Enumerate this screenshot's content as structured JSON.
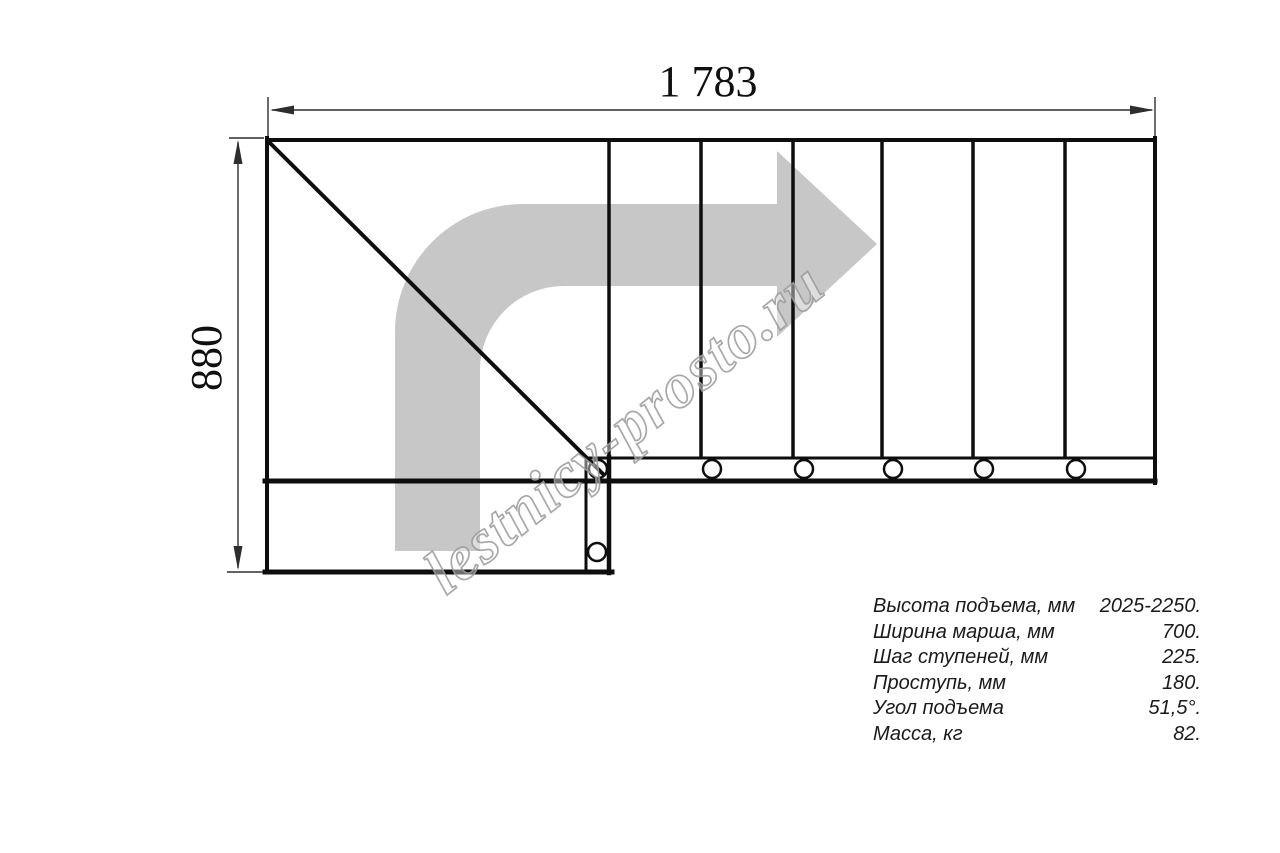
{
  "drawing": {
    "dim_width_label": "1 783",
    "dim_height_label": "880",
    "watermark": "lestnicy-prosto.ru",
    "colors": {
      "plan_line": "#0e0e0e",
      "dim_line": "#2e2e2e",
      "arrow_gray": "#c7c7c7",
      "watermark_gray": "#9f9f9f"
    }
  },
  "specs": {
    "rows": [
      {
        "label": "Высота подъема, мм",
        "value": "2025-2250."
      },
      {
        "label": "Ширина марша, мм",
        "value": "700."
      },
      {
        "label": "Шаг ступеней, мм",
        "value": "225."
      },
      {
        "label": "Проступь, мм",
        "value": "180."
      },
      {
        "label": "Угол подъема",
        "value": "51,5°."
      },
      {
        "label": "Масса, кг",
        "value": "82."
      }
    ]
  }
}
